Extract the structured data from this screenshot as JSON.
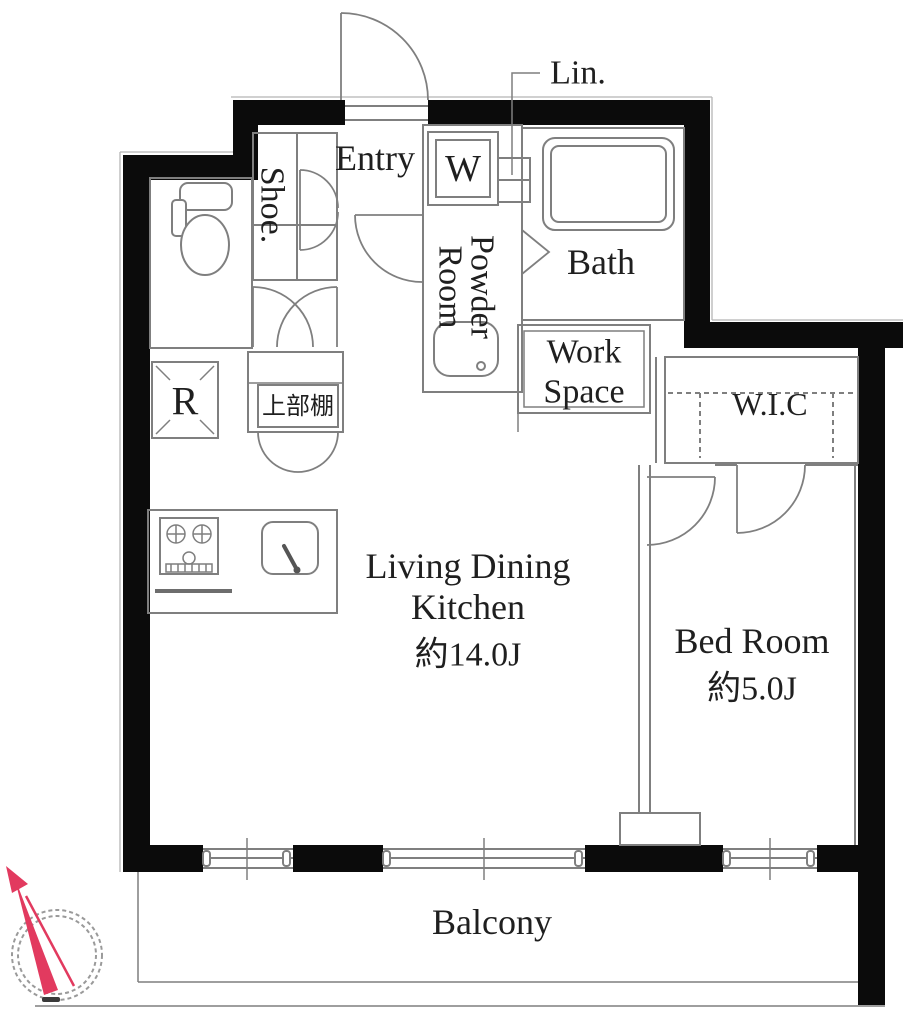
{
  "meta": {
    "type": "floor-plan"
  },
  "rooms": {
    "entry": {
      "label": "Entry"
    },
    "shoe": {
      "label": "Shoe."
    },
    "washer": {
      "label": "W"
    },
    "linen": {
      "label": "Lin."
    },
    "powder_room": {
      "line1": "Powder",
      "line2": "Room"
    },
    "bath": {
      "label": "Bath"
    },
    "work_space": {
      "line1": "Work",
      "line2": "Space"
    },
    "wic": {
      "label": "W.I.C"
    },
    "bed_room": {
      "label": "Bed Room",
      "size": "約5.0J"
    },
    "ldk": {
      "line1": "Living Dining",
      "line2": "Kitchen",
      "size": "約14.0J"
    },
    "refrigerator": {
      "label": "R"
    },
    "upper_shelf": {
      "label": "上部棚"
    },
    "balcony": {
      "label": "Balcony"
    }
  },
  "colors": {
    "wall": "#0b0b0b",
    "line": "#7f7f7f",
    "text": "#1f1f1f",
    "compass_red": "#e23a5f",
    "background": "#ffffff"
  }
}
